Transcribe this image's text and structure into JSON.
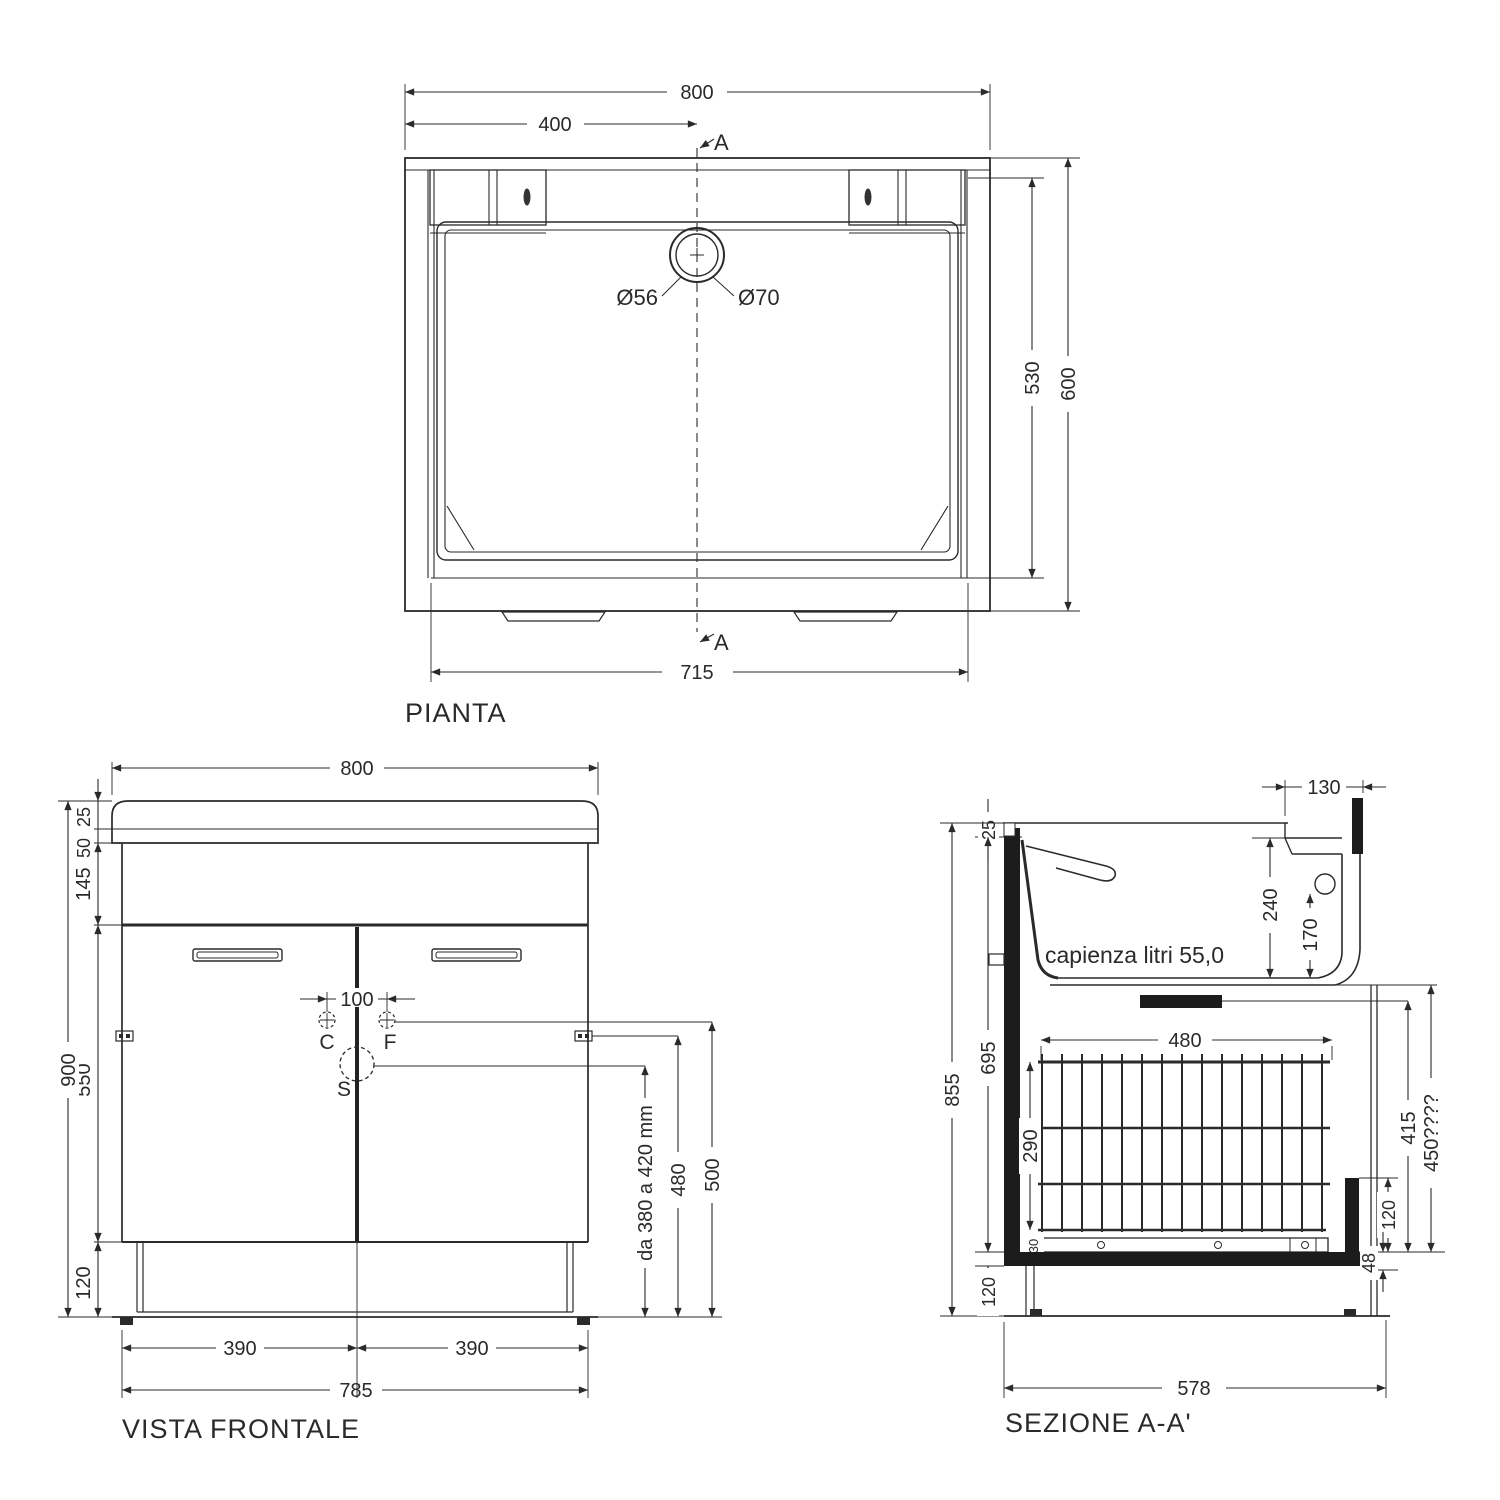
{
  "drawing": {
    "background": "#ffffff",
    "ink_color": "#2a2a2a",
    "pianta": {
      "title": "PIANTA",
      "dim_width_total": "800",
      "dim_width_half": "400",
      "section_marker_top": "A",
      "section_marker_bottom": "A",
      "drain_diameter_inner": "Ø56",
      "drain_diameter_outer": "Ø70",
      "dim_depth_inner": "530",
      "dim_depth_total": "600",
      "dim_width_bottom": "715"
    },
    "frontale": {
      "title": "VISTA FRONTALE",
      "dim_width_total": "800",
      "dim_top_edge": "25",
      "dim_top_band": "50",
      "dim_apron": "145",
      "dim_height_total": "900",
      "dim_doors": "550",
      "dim_plinth": "120",
      "dim_holes_gap": "100",
      "label_c": "C",
      "label_f": "F",
      "label_s": "S",
      "dim_siphon_range": "da 380 a 420 mm",
      "dim_480": "480",
      "dim_500": "500",
      "dim_door_left": "390",
      "dim_door_right": "390",
      "dim_width_body": "785"
    },
    "sezione": {
      "title": "SEZIONE A-A'",
      "capacity_note": "capienza litri 55,0",
      "dim_ledge": "130",
      "dim_rim": "25",
      "dim_tub_depth": "240",
      "dim_overflow": "170",
      "dim_height_total": "855",
      "dim_inner_height": "695",
      "dim_basket_height": "290",
      "dim_support": "30",
      "dim_basket_width": "480",
      "dim_415": "415",
      "dim_450": "450????",
      "dim_runner": "120",
      "dim_48": "48",
      "dim_plinth": "120",
      "dim_depth_body": "578"
    }
  }
}
